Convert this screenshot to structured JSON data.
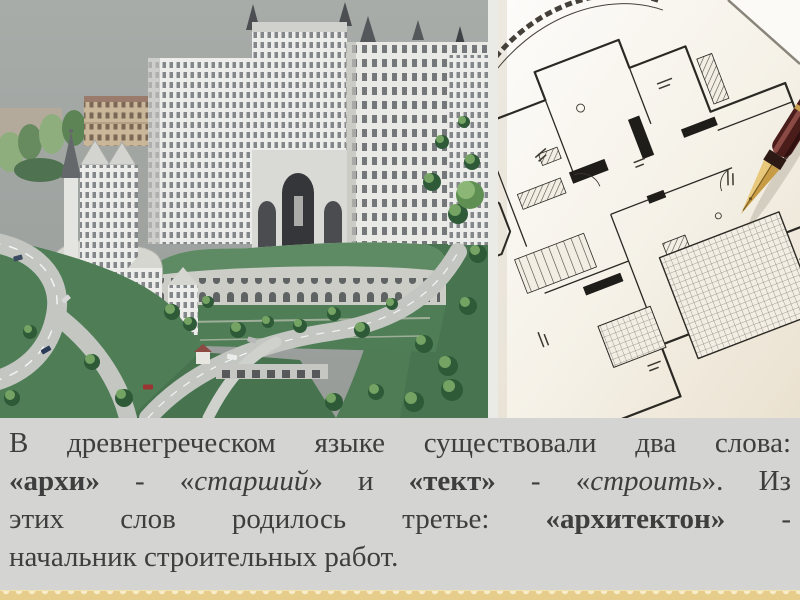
{
  "slide": {
    "background_color": "#d4d4d2",
    "text_color": "#3e3e3e",
    "border_strip_color": "#e7cd8c"
  },
  "images": {
    "left": {
      "description": "Architectural scale model of a hillside city block with classical high-rise buildings, roads, cars and trees"
    },
    "right": {
      "description": "Hand-drawn architectural floor plan with a fountain pen resting on it"
    }
  },
  "text_block": {
    "lines": [
      {
        "justify": true,
        "segments": [
          {
            "text": "В древнегреческом языке существовали два слова:",
            "style": "n"
          }
        ]
      },
      {
        "justify": true,
        "segments": [
          {
            "text": "«архи»",
            "style": "b"
          },
          {
            "text": " - «",
            "style": "n"
          },
          {
            "text": "старший",
            "style": "i"
          },
          {
            "text": "» и ",
            "style": "n"
          },
          {
            "text": "«тект»",
            "style": "b"
          },
          {
            "text": " - «",
            "style": "n"
          },
          {
            "text": "строить",
            "style": "i"
          },
          {
            "text": "». Из",
            "style": "n"
          }
        ]
      },
      {
        "justify": true,
        "segments": [
          {
            "text": "этих слов родилось третье: ",
            "style": "n"
          },
          {
            "text": "«архитектон»",
            "style": "b"
          },
          {
            "text": " -",
            "style": "n"
          }
        ]
      },
      {
        "justify": false,
        "segments": [
          {
            "text": "начальник строительных работ.",
            "style": "n"
          }
        ]
      }
    ]
  }
}
